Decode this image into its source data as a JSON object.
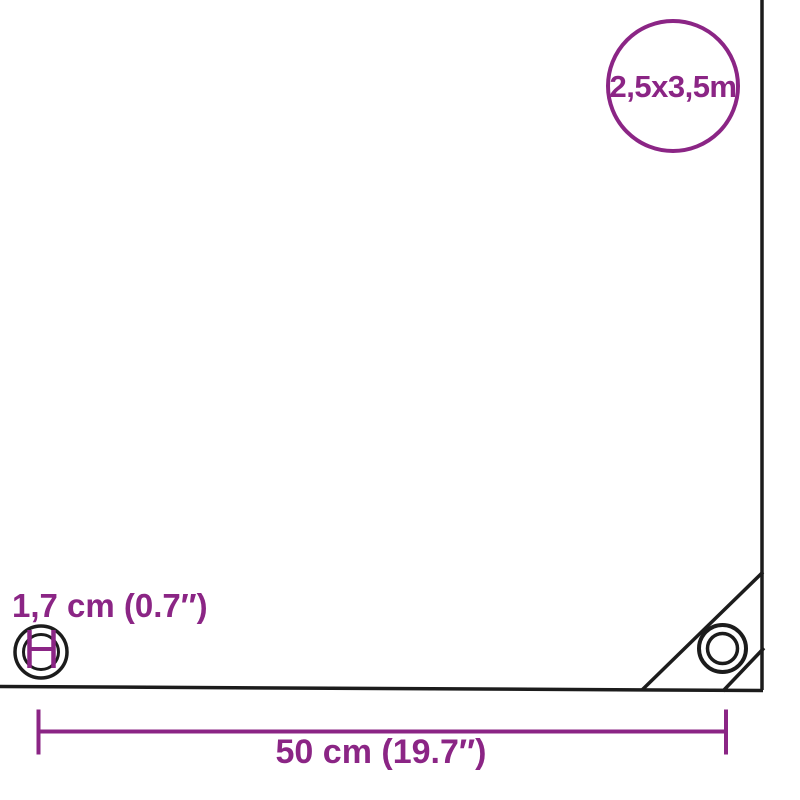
{
  "diagram": {
    "description": "Tarpaulin product dimension diagram",
    "background": "#ffffff",
    "colors": {
      "accent": "#8B2585",
      "outline": "#1C1C1C"
    },
    "size_badge": {
      "label": "2,5x3,5m"
    },
    "eyelet_diameter": {
      "label": "1,7 cm (0.7″)"
    },
    "eyelet_spacing": {
      "label": "50 cm (19.7″)"
    }
  }
}
